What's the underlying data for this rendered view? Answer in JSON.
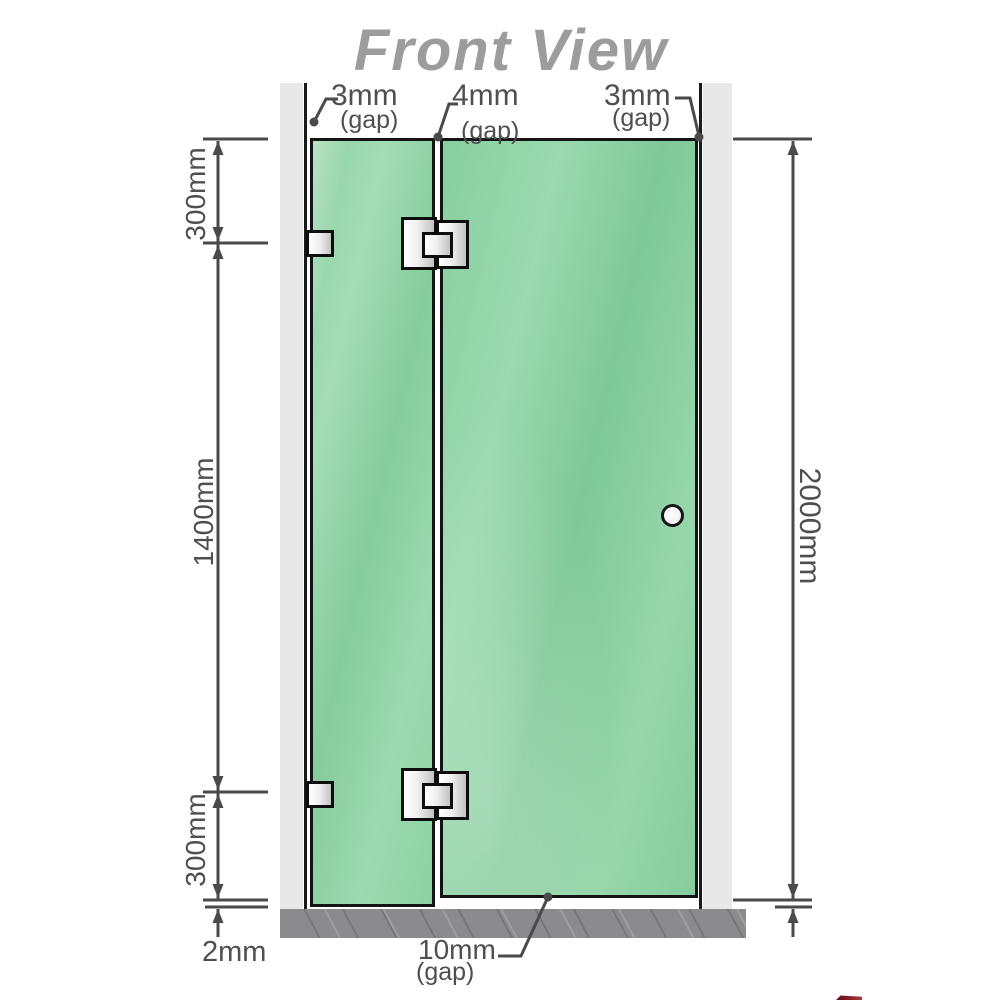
{
  "diagram": {
    "title": "Front View",
    "top_gaps": {
      "left": {
        "value": "3mm",
        "unit": "(gap)"
      },
      "middle": {
        "value": "4mm",
        "unit": "(gap)"
      },
      "right": {
        "value": "3mm",
        "unit": "(gap)"
      }
    },
    "bottom_gap": {
      "value": "10mm",
      "unit": "(gap)"
    },
    "floor_gap": {
      "value": "2mm"
    },
    "side_dimensions": {
      "left_top": "300mm",
      "left_middle": "1400mm",
      "left_bottom": "300mm",
      "right": "2000mm"
    },
    "colors": {
      "glass_green": "#8ed1a4",
      "glass_green_dark": "#7fc897",
      "wall_gray": "#e8e8e8",
      "floor_gray": "#8b8b8e",
      "outline_black": "#141414",
      "dimension_gray": "#4a4a4a",
      "title_gray": "#9c9c9c",
      "hardware_silver": "#e9e9e9"
    }
  }
}
